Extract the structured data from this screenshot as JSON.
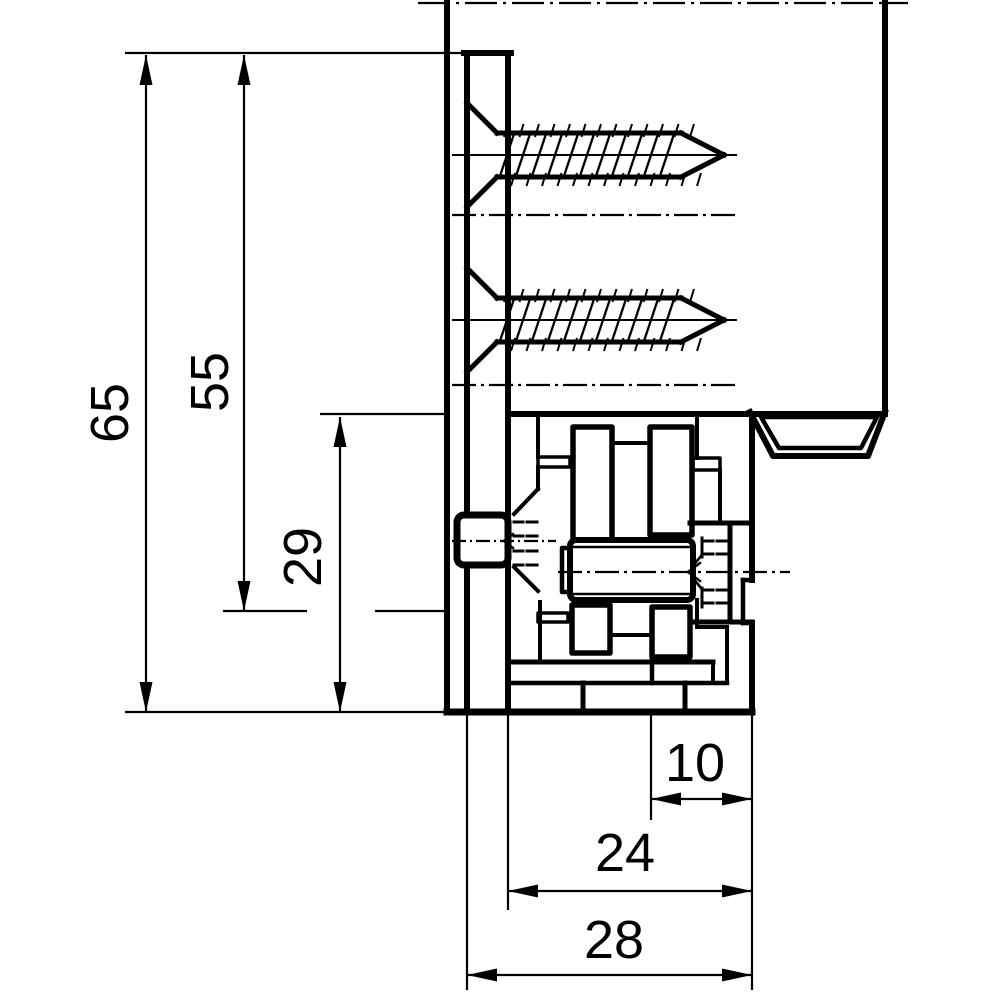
{
  "drawing": {
    "type": "technical-section-drawing",
    "subject": "cabinet mounting bracket cross-section",
    "units": "mm",
    "stroke_color": "#000000",
    "background_color": "#ffffff",
    "width": 1000,
    "height": 1000
  },
  "dimensions": [
    {
      "label": "65",
      "value": 65,
      "axis": "vertical",
      "line": {
        "x": 146,
        "y1": 55,
        "y2": 712
      },
      "arrows": [
        {
          "x": 146,
          "y": 55,
          "dir": "up"
        },
        {
          "x": 146,
          "y": 712,
          "dir": "down"
        }
      ],
      "text": {
        "x": 128,
        "y": 413,
        "rot": -90
      }
    },
    {
      "label": "55",
      "value": 55,
      "axis": "vertical",
      "line": {
        "x": 244,
        "y1": 55,
        "y2": 611
      },
      "arrows": [
        {
          "x": 244,
          "y": 55,
          "dir": "up"
        },
        {
          "x": 244,
          "y": 611,
          "dir": "down"
        }
      ],
      "text": {
        "x": 228,
        "y": 382,
        "rot": -90
      }
    },
    {
      "label": "29",
      "value": 29,
      "axis": "vertical",
      "line": {
        "x": 340,
        "y1": 417,
        "y2": 712
      },
      "arrows": [
        {
          "x": 340,
          "y": 417,
          "dir": "up"
        },
        {
          "x": 340,
          "y": 712,
          "dir": "down"
        }
      ],
      "text": {
        "x": 321,
        "y": 557,
        "rot": -90
      }
    },
    {
      "label": "10",
      "value": 10,
      "axis": "horizontal",
      "line": {
        "y": 799,
        "x1": 651,
        "x2": 752
      },
      "arrows": [
        {
          "x": 651,
          "y": 799,
          "dir": "left"
        },
        {
          "x": 752,
          "y": 799,
          "dir": "right"
        }
      ],
      "text": {
        "x": 695,
        "y": 781,
        "rot": 0
      }
    },
    {
      "label": "24",
      "value": 24,
      "axis": "horizontal",
      "line": {
        "y": 891,
        "x1": 508,
        "x2": 752
      },
      "arrows": [
        {
          "x": 508,
          "y": 891,
          "dir": "left"
        },
        {
          "x": 752,
          "y": 891,
          "dir": "right"
        }
      ],
      "text": {
        "x": 625,
        "y": 871,
        "rot": 0
      }
    },
    {
      "label": "28",
      "value": 28,
      "axis": "horizontal",
      "line": {
        "y": 975,
        "x1": 467,
        "x2": 752
      },
      "arrows": [
        {
          "x": 467,
          "y": 975,
          "dir": "left"
        },
        {
          "x": 752,
          "y": 975,
          "dir": "right"
        }
      ],
      "text": {
        "x": 614,
        "y": 958,
        "rot": 0
      }
    }
  ],
  "extension_lines": [
    [
      125,
      53,
      467,
      53
    ],
    [
      320,
      414,
      445,
      414
    ],
    [
      223,
      611,
      307,
      611
    ],
    [
      375,
      611,
      445,
      611
    ],
    [
      125,
      712,
      447,
      712
    ],
    [
      467,
      712,
      467,
      990
    ],
    [
      508,
      712,
      508,
      910
    ],
    [
      651,
      712,
      651,
      820
    ],
    [
      752,
      712,
      752,
      990
    ]
  ],
  "centerlines": [
    {
      "line": [
        418,
        3,
        908,
        3
      ],
      "dash": "32 6 3 6"
    },
    {
      "line": [
        452,
        215,
        737,
        215
      ],
      "dash": "24 5 3 5"
    },
    {
      "line": [
        452,
        385,
        737,
        385
      ],
      "dash": "24 5 3 5"
    },
    {
      "line": [
        558,
        572,
        790,
        572
      ],
      "dash": "24 5 3 5"
    },
    {
      "line": [
        452,
        541,
        556,
        541
      ],
      "dash": "14 4 2 4"
    }
  ],
  "screws": {
    "centers_y": [
      155,
      320
    ],
    "head_x": 467,
    "shaft_x1": 497,
    "shaft_x2": 681,
    "tip_x": 724,
    "half_head": 52,
    "half_shaft": 22,
    "crest_overhang": 9,
    "axis_x1": 452,
    "axis_x2": 737
  },
  "geometry_groups": [
    {
      "name": "wall-panel",
      "lines": [
        [
          447,
          3,
          447,
          712,
          6
        ],
        [
          885,
          3,
          885,
          411,
          6
        ]
      ]
    },
    {
      "name": "mounting-plate",
      "lines": [
        [
          467,
          53,
          467,
          515,
          6
        ],
        [
          467,
          565,
          467,
          712,
          6
        ],
        [
          508,
          53,
          508,
          712,
          6
        ],
        [
          464,
          53,
          511,
          53,
          6
        ]
      ]
    },
    {
      "name": "hinge-body",
      "lines": [
        [
          508,
          414,
          885,
          414,
          6
        ],
        [
          752,
          414,
          752,
          580,
          6
        ],
        [
          743,
          580,
          743,
          623,
          4.5
        ],
        [
          743,
          580,
          752,
          580,
          4.5
        ],
        [
          743,
          623,
          752,
          623,
          4.5
        ],
        [
          752,
          623,
          752,
          712,
          6
        ],
        [
          447,
          712,
          752,
          712,
          7
        ],
        [
          612,
          443,
          612,
          540,
          4
        ],
        [
          650,
          443,
          650,
          540,
          4
        ],
        [
          612,
          443,
          650,
          443,
          4
        ],
        [
          538,
          414,
          538,
          457,
          4
        ],
        [
          538,
          467,
          538,
          489,
          4
        ],
        [
          697,
          414,
          697,
          458,
          4
        ],
        [
          720,
          470,
          720,
          523,
          4
        ],
        [
          690,
          523,
          752,
          523,
          5
        ],
        [
          690,
          622,
          752,
          622,
          5
        ],
        [
          730,
          523,
          730,
          622,
          5
        ],
        [
          540,
          602,
          540,
          662,
          4
        ],
        [
          610,
          635,
          652,
          635,
          4
        ],
        [
          697,
          600,
          697,
          627,
          4
        ],
        [
          697,
          627,
          727,
          627,
          4
        ],
        [
          727,
          627,
          727,
          683,
          4
        ],
        [
          713,
          662,
          713,
          683,
          4
        ],
        [
          510,
          662,
          713,
          662,
          5
        ],
        [
          510,
          683,
          727,
          683,
          4.5
        ],
        [
          583,
          683,
          583,
          712,
          5
        ],
        [
          685,
          683,
          685,
          712,
          5
        ],
        [
          652,
          657,
          652,
          683,
          4.5
        ]
      ],
      "rects": [
        [
          573,
          427,
          39,
          113,
          5.5,
          0
        ],
        [
          650,
          427,
          42,
          108,
          5.5,
          0
        ],
        [
          572,
          605,
          38,
          48,
          5.5,
          0
        ],
        [
          652,
          607,
          38,
          50,
          5.5,
          0
        ],
        [
          538,
          457,
          32,
          10,
          3.5,
          0
        ],
        [
          693,
          458,
          27,
          12,
          3.5,
          0
        ],
        [
          538,
          613,
          30,
          9,
          3.5,
          0
        ]
      ]
    },
    {
      "name": "adjustment-bolt",
      "lines": [
        [
          514,
          514,
          538,
          489,
          4
        ],
        [
          514,
          567,
          538,
          591,
          4
        ],
        [
          504,
          541,
          513,
          534,
          2.4
        ],
        [
          504,
          541,
          513,
          548,
          2.4
        ],
        [
          514,
          522,
          523,
          522,
          3
        ],
        [
          527,
          522,
          537,
          522,
          3
        ],
        [
          514,
          536,
          523,
          536,
          3
        ],
        [
          527,
          536,
          537,
          536,
          3
        ],
        [
          514,
          551,
          523,
          551,
          3
        ],
        [
          527,
          551,
          537,
          551,
          3
        ],
        [
          514,
          565,
          523,
          565,
          3
        ],
        [
          527,
          565,
          537,
          565,
          3
        ]
      ],
      "rects": [
        [
          457,
          515,
          51,
          50,
          7,
          7
        ]
      ]
    },
    {
      "name": "barrel",
      "lines": [
        [
          572,
          547,
          691,
          547,
          2.4
        ],
        [
          572,
          594,
          691,
          594,
          2.4
        ]
      ],
      "rects": [
        [
          570,
          540,
          123,
          60,
          6,
          6
        ],
        [
          562,
          548,
          8,
          44,
          4.5,
          0
        ]
      ]
    },
    {
      "name": "detent-screw-hidden",
      "lines": [
        [
          702,
          538,
          702,
          547,
          3
        ],
        [
          702,
          550,
          702,
          557,
          3
        ],
        [
          702,
          588,
          702,
          596,
          3
        ],
        [
          702,
          599,
          702,
          607,
          3
        ],
        [
          705,
          541,
          713,
          541,
          3
        ],
        [
          717,
          541,
          726,
          541,
          3
        ],
        [
          705,
          554,
          713,
          554,
          3
        ],
        [
          717,
          554,
          726,
          554,
          3
        ],
        [
          705,
          590,
          713,
          590,
          3
        ],
        [
          717,
          590,
          726,
          590,
          3
        ],
        [
          705,
          603,
          713,
          603,
          3
        ],
        [
          717,
          603,
          726,
          603,
          3
        ],
        [
          692,
          567,
          701,
          556,
          2.6
        ],
        [
          692,
          577,
          701,
          588,
          2.6
        ],
        [
          688,
          572,
          700,
          563,
          2.4
        ],
        [
          688,
          572,
          700,
          581,
          2.4
        ]
      ]
    },
    {
      "name": "rail-clip",
      "polys": [
        {
          "pts": [
            [
              750,
              412
            ],
            [
              773,
              456
            ],
            [
              868,
              456
            ],
            [
              885,
              412
            ]
          ],
          "sw": 6,
          "close": false
        },
        {
          "pts": [
            [
              761,
              417
            ],
            [
              877,
              417
            ],
            [
              861,
              448
            ],
            [
              779,
              448
            ]
          ],
          "sw": 4.5,
          "close": true
        }
      ]
    }
  ],
  "style": {
    "thin_width": 2.2,
    "label_font_size": 54,
    "arrow_length": 30,
    "arrow_half_width": 6.5
  }
}
